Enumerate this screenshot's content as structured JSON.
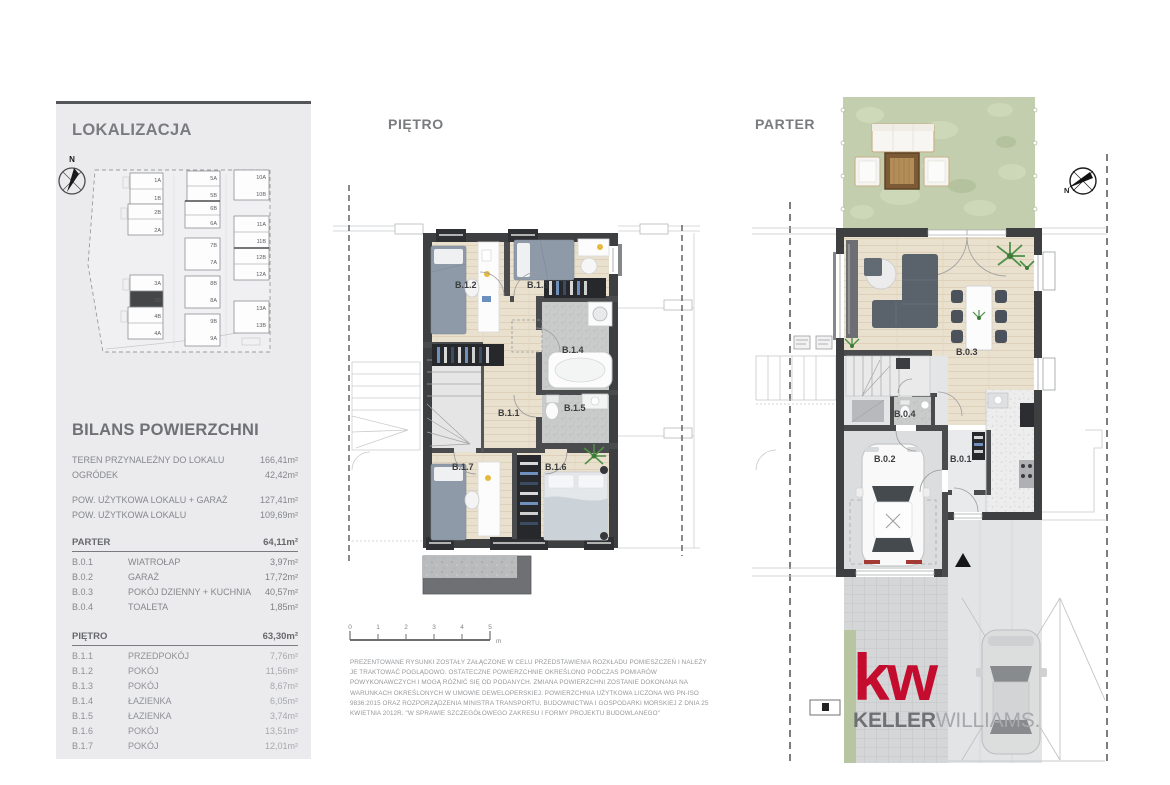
{
  "left_panel": {
    "title": "LOKALIZACJA",
    "compass_label": "N",
    "site_map": {
      "highlighted_unit": "3B",
      "units": [
        "1A",
        "1B",
        "2B",
        "2A",
        "3A",
        "3B",
        "4B",
        "4A",
        "5A",
        "5B",
        "6B",
        "6A",
        "7B",
        "7A",
        "8B",
        "8A",
        "9B",
        "9A",
        "10A",
        "10B",
        "11A",
        "11B",
        "12B",
        "12A",
        "13A",
        "13B"
      ]
    },
    "bilans_title": "BILANS POWIERZCHNI",
    "summary": [
      {
        "label": "TEREN PRZYNALEŻNY DO LOKALU",
        "value": "166,41m²"
      },
      {
        "label": "OGRÓDEK",
        "value": "42,42m²"
      },
      {
        "label": "POW. UŻYTKOWA LOKALU + GARAŻ",
        "value": "127,41m²"
      },
      {
        "label": "POW. UŻYTKOWA LOKALU",
        "value": "109,69m²"
      }
    ],
    "parter_section": {
      "header": "PARTER",
      "total": "64,11m²",
      "rows": [
        {
          "code": "B.0.1",
          "name": "WIATROŁAP",
          "value": "3,97m²"
        },
        {
          "code": "B.0.2",
          "name": "GARAŻ",
          "value": "17,72m²"
        },
        {
          "code": "B.0.3",
          "name": "POKÓJ DZIENNY + KUCHNIA",
          "value": "40,57m²"
        },
        {
          "code": "B.0.4",
          "name": "TOALETA",
          "value": "1,85m²"
        }
      ]
    },
    "pietro_section": {
      "header": "PIĘTRO",
      "total": "63,30m²",
      "rows": [
        {
          "code": "B.1.1",
          "name": "PRZEDPOKÓJ",
          "value": "7,76m²"
        },
        {
          "code": "B.1.2",
          "name": "POKÓJ",
          "value": "11,56m²"
        },
        {
          "code": "B.1.3",
          "name": "POKÓJ",
          "value": "8,67m²"
        },
        {
          "code": "B.1.4",
          "name": "ŁAZIENKA",
          "value": "6,05m²"
        },
        {
          "code": "B.1.5",
          "name": "ŁAZIENKA",
          "value": "3,74m²"
        },
        {
          "code": "B.1.6",
          "name": "POKÓJ",
          "value": "13,51m²"
        },
        {
          "code": "B.1.7",
          "name": "POKÓJ",
          "value": "12,01m²"
        }
      ]
    }
  },
  "pietro_plan": {
    "title": "PIĘTRO",
    "rooms": {
      "b11": "B.1.1",
      "b12": "B.1.2",
      "b13": "B.1.3",
      "b14": "B.1.4",
      "b15": "B.1.5",
      "b16": "B.1.6",
      "b17": "B.1.7"
    },
    "scale_bar": {
      "ticks": [
        "0",
        "1",
        "2",
        "3",
        "4",
        "5"
      ],
      "unit": "m"
    },
    "disclaimer": "PREZENTOWANE RYSUNKI ZOSTAŁY ZAŁĄCZONE W CELU PRZEDSTAWIENIA ROZKŁADU POMIESZCZEŃ I NALEŻY JE TRAKTOWAĆ POGLĄDOWO. OSTATECZNE POWIERZCHNIE OKREŚLONO PODCZAS POMIARÓW POWYKONAWCZYCH I MOGĄ RÓŻNIĆ SIĘ OD PODANYCH. ZMIANA POWIERZCHNI ZOSTANIE DOKONANA NA WARUNKACH OKREŚLONYCH W UMOWIE DEWELOPERSKIEJ. POWIERZCHNIA UŻYTKOWA LICZONA WG PN-ISO 9836:2015 ORAZ ROZPORZĄDZENIA MINISTRA TRANSPORTU, BUDOWNICTWA I GOSPODARKI MORSKIEJ Z DNIA 25 KWIETNIA 2012R. \"W SPRAWIE SZCZEGÓŁOWEGO ZAKRESU I FORMY PROJEKTU BUDOWLANEGO\""
  },
  "parter_plan": {
    "title": "PARTER",
    "compass_label": "N",
    "rooms": {
      "b01": "B.0.1",
      "b02": "B.0.2",
      "b03": "B.0.3",
      "b04": "B.0.4"
    }
  },
  "logo": {
    "kw": "kw",
    "keller": "KELLER",
    "williams": "WILLIAMS",
    "period": "."
  },
  "colors": {
    "brand_red": "#c40d2e",
    "wall_dark": "#3e3f41",
    "panel_bg": "#ebebed",
    "heading_gray": "#77787b",
    "wood_floor": "#e9e0ce",
    "garden_green": "#c2cead"
  }
}
